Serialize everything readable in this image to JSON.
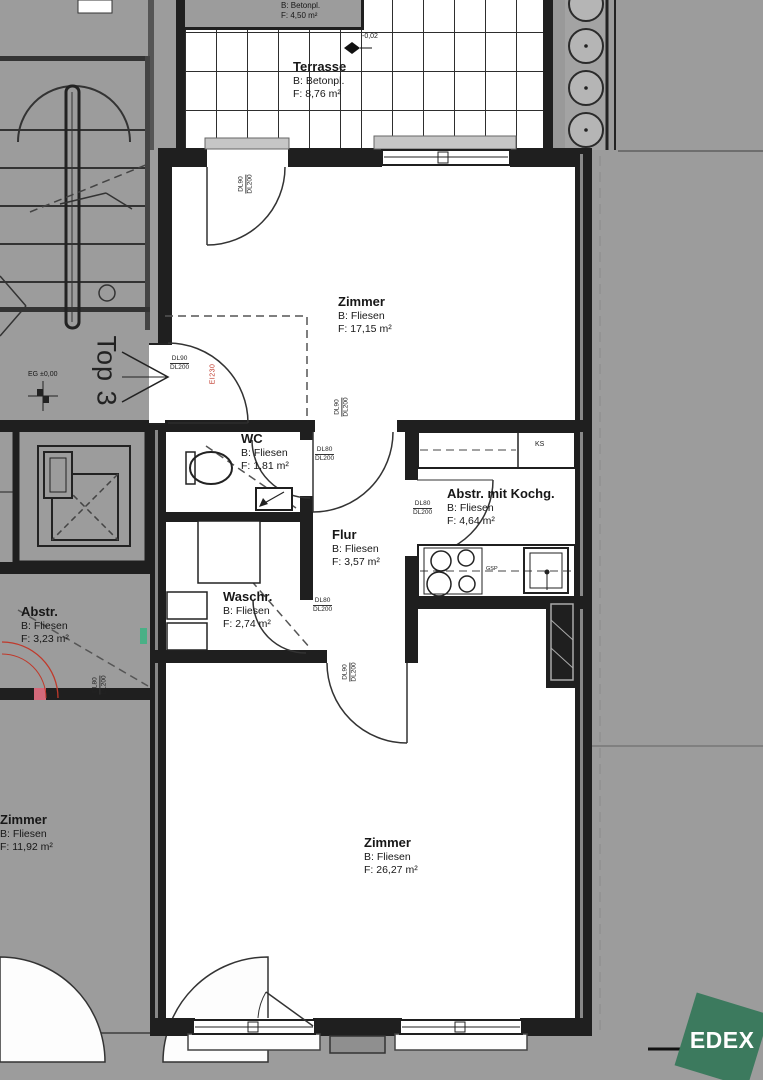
{
  "unit_label": "Top 3",
  "rooms": {
    "terrasse": {
      "name": "Terrasse",
      "surface": "B: Betonpl.",
      "area": "F: 8,76 m²"
    },
    "terrasse_upper": {
      "surface": "B: Betonpl.",
      "area": "F: 4,50 m²"
    },
    "zimmer_top": {
      "name": "Zimmer",
      "surface": "B: Fliesen",
      "area": "F: 17,15 m²"
    },
    "wc": {
      "name": "WC",
      "surface": "B: Fliesen",
      "area": "F: 1,81 m²"
    },
    "abstell_kueche": {
      "name": "Abstr. mit Kochg.",
      "surface": "B: Fliesen",
      "area": "F: 4,64 m²"
    },
    "flur": {
      "name": "Flur",
      "surface": "B: Fliesen",
      "area": "F: 3,57 m²"
    },
    "waschraum": {
      "name": "Waschr.",
      "surface": "B: Fliesen",
      "area": "F: 2,74 m²"
    },
    "abstellraum": {
      "name": "Abstr.",
      "surface": "B: Fliesen",
      "area": "F: 3,23 m²"
    },
    "zimmer_left": {
      "name": "Zimmer",
      "surface": "B: Fliesen",
      "area": "F: 11,92 m²"
    },
    "zimmer_bottom": {
      "name": "Zimmer",
      "surface": "B: Fliesen",
      "area": "F: 26,27 m²"
    }
  },
  "levels": {
    "ground": "EG ±0,00",
    "terrace": "-0,02"
  },
  "door_labels": {
    "dl80": "DL80",
    "dl90": "DL90",
    "dl200": "DL200"
  },
  "fire_rating": "EI230",
  "appliances": {
    "fridge": "KS",
    "dishwasher": "GSP"
  },
  "logo": {
    "text": "EDEX",
    "color": "#3c7a5e"
  },
  "colors": {
    "background": "#9c9c9c",
    "wall": "#1f1f1f",
    "interior": "#ffffff",
    "accent_red": "#c0392b",
    "accent_green": "#49b086",
    "logo_green": "#3c7a5e"
  }
}
